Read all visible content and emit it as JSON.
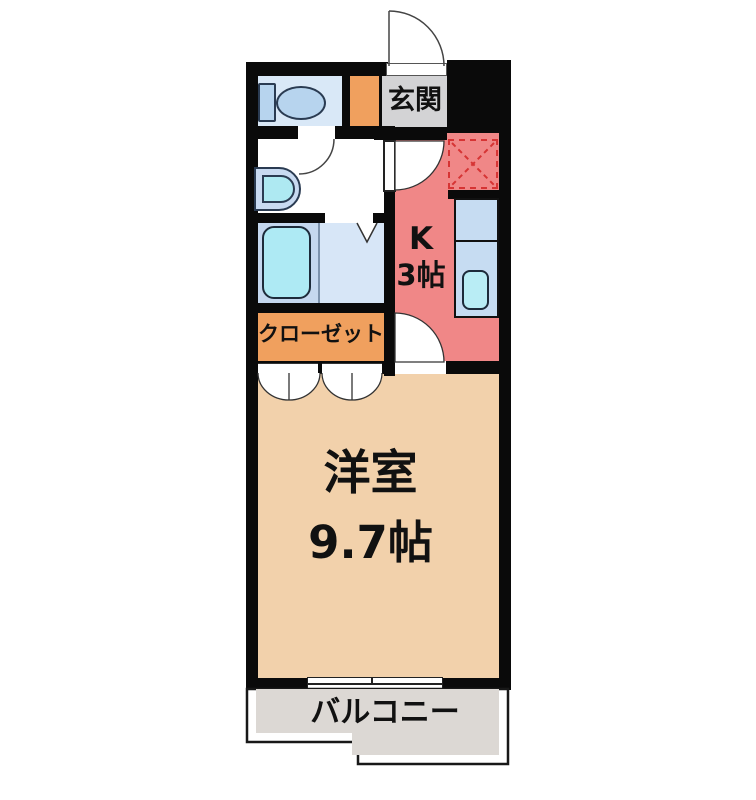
{
  "plan": {
    "type": "apartment-floor-plan",
    "rooms": {
      "entrance": {
        "label": "玄関"
      },
      "kitchen": {
        "label": "K",
        "size_label": "3帖"
      },
      "closet": {
        "label": "クローゼット"
      },
      "western_room": {
        "label": "洋室",
        "size_label": "9.7帖"
      },
      "balcony": {
        "label": "バルコニー"
      }
    },
    "fixtures": [
      "toilet",
      "washbasin",
      "bathtub",
      "kitchen-counter",
      "kitchen-sink",
      "refrigerator-space",
      "sliding-window",
      "entrance-door",
      "closet-double-doors",
      "bathroom-folding-door"
    ],
    "colors": {
      "wall": "#0a0a0a",
      "kitchen": "#f08787",
      "western_room": "#f2d1ab",
      "closet": "#f0a05e",
      "entrance_floor": "#d3d3d5",
      "entrance_step": "#f0a05e",
      "toilet_room": "#d9e8f7",
      "bathroom_left": "#c5d8ef",
      "bathroom_right": "#d7e6f7",
      "fixture_blue": "#c6dcf2",
      "water_cyan": "#aeeaf4",
      "balcony": "#dcd8d4",
      "refrigerator_dash": "#d63434"
    }
  }
}
